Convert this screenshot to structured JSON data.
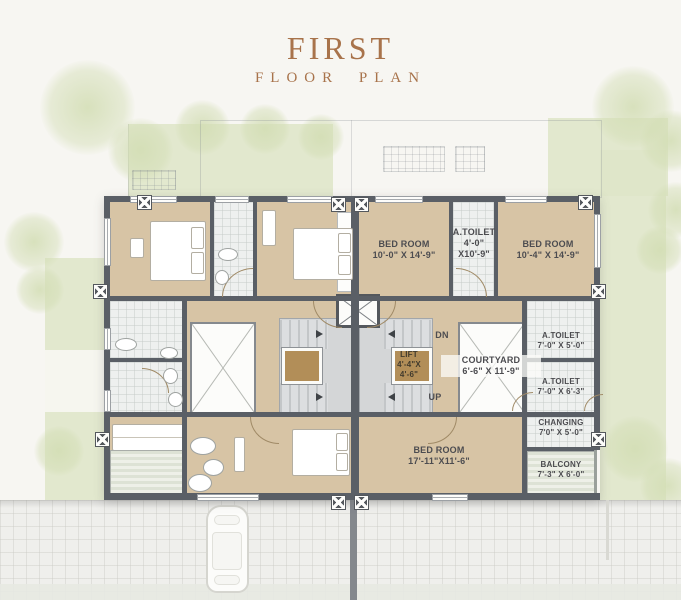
{
  "title": {
    "main": "FIRST",
    "sub": "FLOOR PLAN"
  },
  "plan": {
    "rooms": {
      "bed_top_left": {
        "name": "BED ROOM",
        "dims": "10'-0\" X 14'-9\""
      },
      "toilet_top": {
        "name": "A.TOILET",
        "dims_line1": "4'-0\"",
        "dims_line2": "X10'-9\""
      },
      "bed_top_right": {
        "name": "BED ROOM",
        "dims": "10'-4\" X 14'-9\""
      },
      "courtyard": {
        "name": "COURTYARD",
        "dims": "6'-6\" X 11'-9\""
      },
      "toilet_mid_upper": {
        "name": "A.TOILET",
        "dims": "7'-0\" X 5'-0\""
      },
      "toilet_mid_lower": {
        "name": "A.TOILET",
        "dims": "7'-0\" X 6'-3\""
      },
      "bed_bottom": {
        "name": "BED ROOM",
        "dims": "17'-11\"X11'-6\""
      },
      "changing": {
        "name": "CHANGING",
        "dims": "7'0\" X 5'-0\""
      },
      "balcony": {
        "name": "BALCONY",
        "dims": "7'-3\" X 6'-0\""
      }
    },
    "lift": {
      "name": "LIFT",
      "dims_line1": "4'-4\"X",
      "dims_line2": "4'-6\""
    },
    "stairs": {
      "down": "DN",
      "up": "UP"
    }
  },
  "colors": {
    "accent": "#a8734b",
    "wall": "#5a5f66",
    "floor": "#d7c4a5",
    "greenery": "#dee5c8"
  }
}
